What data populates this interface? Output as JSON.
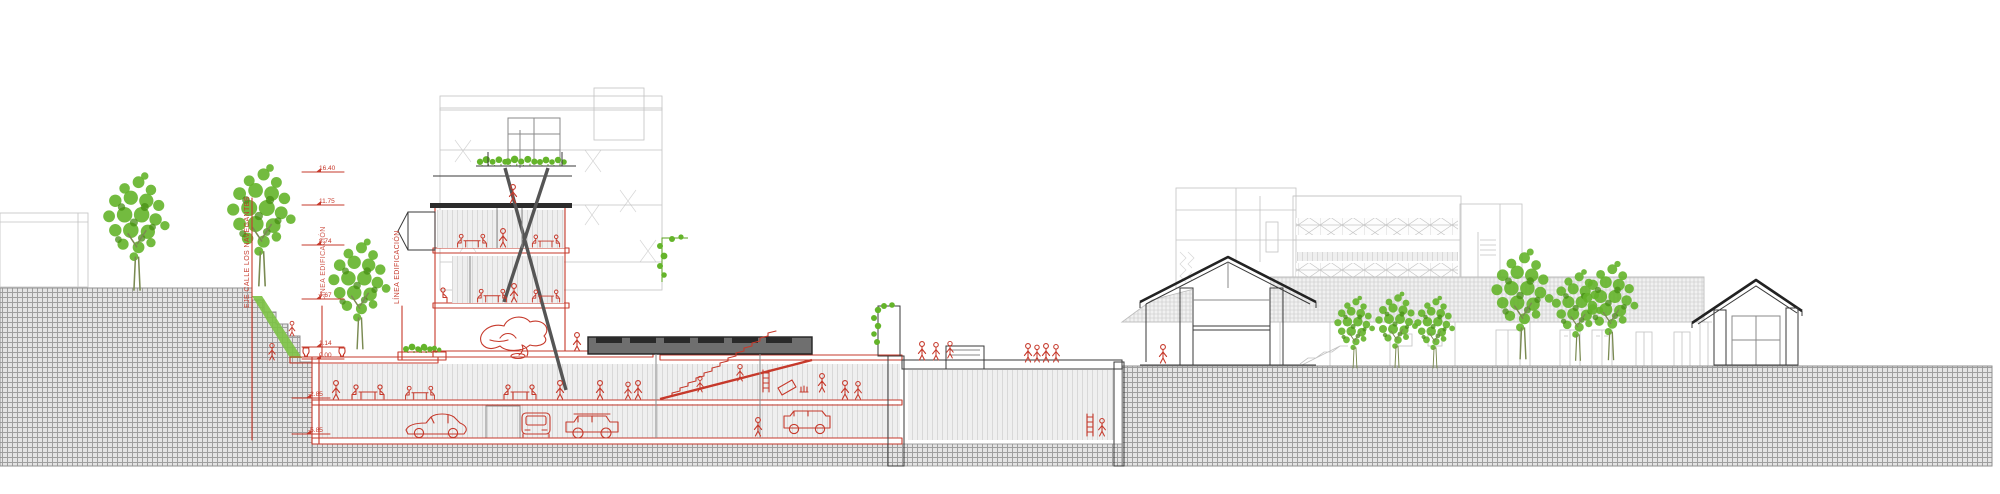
{
  "drawing": {
    "kind": "architectural longitudinal section / elevation",
    "labels": {
      "street_axis": "EJE CALLE LOS NAVEGANTES",
      "building_line_left": "LÍNEA EDIFICACIÓN",
      "building_line_right": "LÍNEA EDIFICACIÓN"
    },
    "levels": [
      {
        "value": "16.40"
      },
      {
        "value": "11.75"
      },
      {
        "value": "8.74"
      },
      {
        "value": "4.67"
      },
      {
        "value": "1.14"
      },
      {
        "value": "0.00"
      },
      {
        "value": "-2.85"
      },
      {
        "value": "-5.85"
      }
    ],
    "colors": {
      "section_red": "#c6392b",
      "vegetation_green": "#62b52a",
      "dark_cut": "#333333",
      "light_line": "#c2c2c2",
      "ground_fill": "#e4e4e4",
      "ground_line": "#9e9e9e",
      "paper": "#ffffff"
    },
    "elements": [
      "street-axis-line",
      "building-line",
      "new-building-red-section",
      "roof-garden",
      "tower-floors",
      "restaurant-tables",
      "sculpture",
      "auditorium-ramp",
      "underground-parking",
      "classic-car",
      "compact-car",
      "offroad-car",
      "van",
      "pedestrian-figures",
      "street-trees",
      "planter",
      "green-wall",
      "vine-pergola",
      "existing-house-section",
      "warehouse-shed-section",
      "small-shed-section",
      "background-curtain-wall-building",
      "background-school-building",
      "exterior-stair",
      "ground-crosshatch",
      "skylight-box",
      "ladder"
    ]
  }
}
